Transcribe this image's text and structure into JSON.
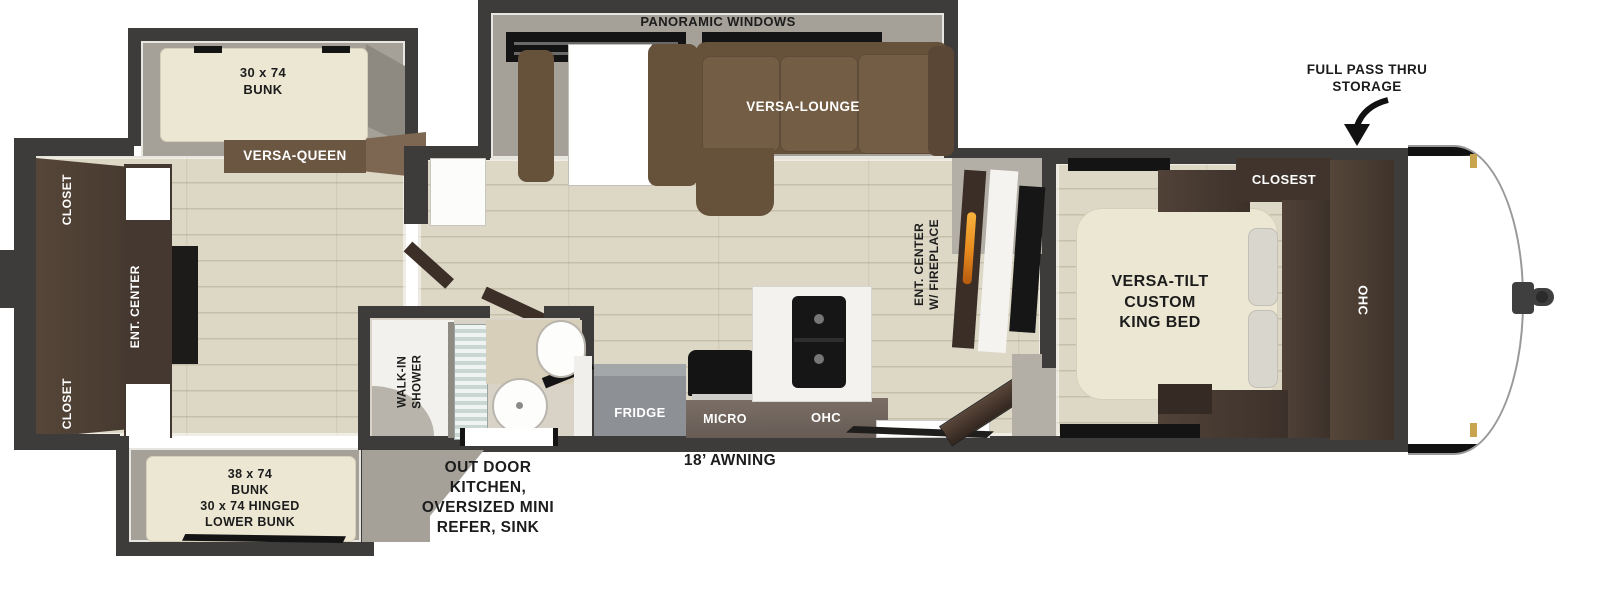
{
  "floorplan": {
    "labels": {
      "panoramic_windows": "PANORAMIC WINDOWS",
      "versa_lounge": "VERSA-LOUNGE",
      "versa_queen": "VERSA-QUEEN",
      "bunk_top": [
        "30 x 74",
        "BUNK"
      ],
      "bunk_bottom": [
        "38 x 74",
        "BUNK",
        "30 x 74 HINGED",
        "LOWER BUNK"
      ],
      "closet_rear_top": "CLOSET",
      "closet_rear_bottom": "CLOSET",
      "ent_center_rear": "ENT. CENTER",
      "walk_in_shower": [
        "WALK-IN",
        "SHOWER"
      ],
      "outdoor_kitchen": [
        "OUT DOOR",
        "KITCHEN,",
        "OVERSIZED MINI",
        "REFER, SINK"
      ],
      "awning": "18’ AWNING",
      "fridge": "FRIDGE",
      "micro": "MICRO",
      "ohc_kitchen": "OHC",
      "ent_center_fireplace": [
        "ENT. CENTER",
        "W/ FIREPLACE"
      ],
      "king_bed": [
        "VERSA-TILT",
        "CUSTOM",
        "KING BED"
      ],
      "closet_bedroom": "CLOSEST",
      "ohc_bedroom": "OHC",
      "full_pass_thru": [
        "FULL PASS THRU",
        "STORAGE"
      ]
    },
    "colors": {
      "wall": "#3e3c3a",
      "floor": "#ddd8c6",
      "slide_floor": "#a5a199",
      "sofa_brown": "#66513b",
      "cabinet_dark": "#473a31",
      "counter_brown": "#6e625a",
      "mattress_cream": "#ece7d3",
      "fridge_gray": "#8d9094",
      "flame_orange": "#e8891d",
      "label_dark": "#1c1c1c",
      "label_light": "#ffffff"
    }
  }
}
